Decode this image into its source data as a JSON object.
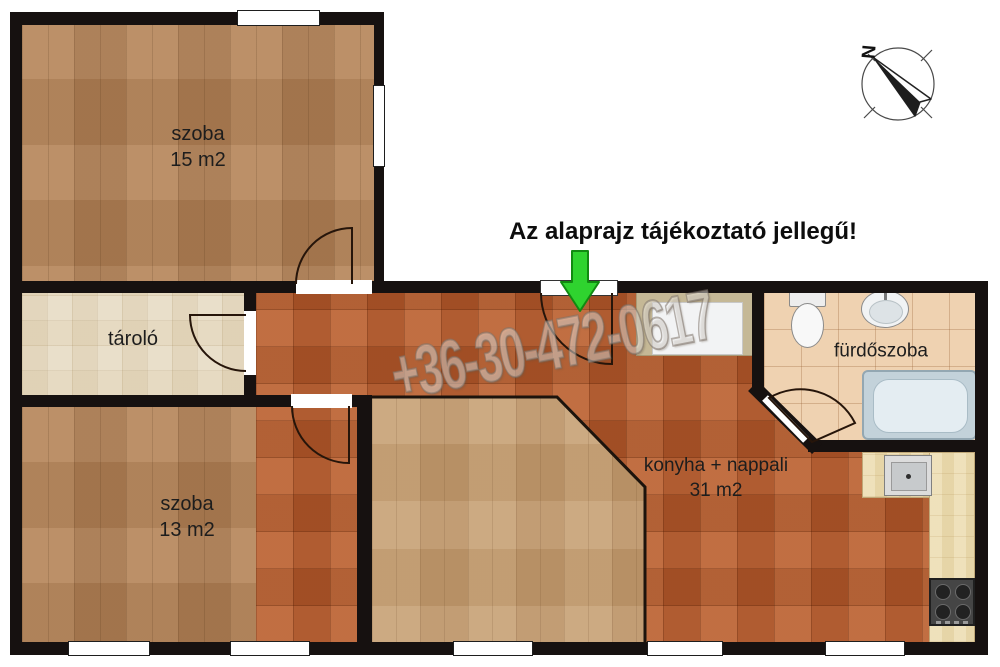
{
  "disclaimer": "Az alaprajz tájékoztató jellegű!",
  "watermark": "+36-30-472-0617",
  "compass": {
    "north": "N"
  },
  "rooms": {
    "bedroom1": {
      "name": "szoba",
      "area": "15 m2"
    },
    "storage": {
      "name": "tároló"
    },
    "bedroom2": {
      "name": "szoba",
      "area": "13 m2"
    },
    "kitchen_living": {
      "name": "konyha + nappali",
      "area": "31 m2"
    },
    "bathroom": {
      "name": "fürdőszoba"
    }
  },
  "colors": {
    "wall": "#161110",
    "bedroom_wood": "#b28257",
    "living_wood": "#c39c70",
    "kitchen_tile": "#b45a2d",
    "storage_tile": "#e9dfca",
    "bathroom_tile": "#efd2b1",
    "counter_wood": "#ecdcb0",
    "entrance_arrow_green": "#2fd32f"
  }
}
